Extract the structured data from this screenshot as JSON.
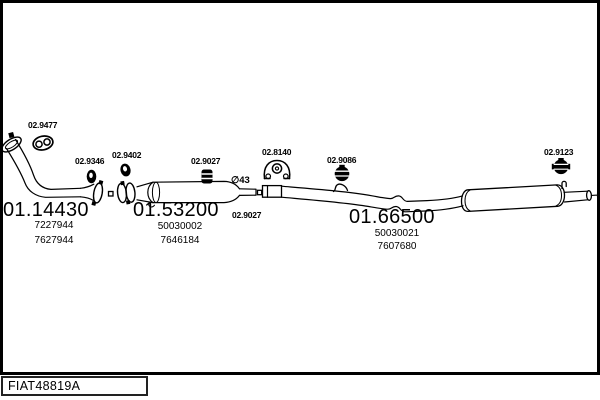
{
  "diagram": {
    "drawing_code": "FIAT48819A",
    "pipe_diameter_label": "∅43",
    "sections": [
      {
        "code": "01.14430",
        "numbers": [
          "7227944",
          "7627944"
        ]
      },
      {
        "code": "01.53200",
        "numbers": [
          "50030002",
          "7646184"
        ]
      },
      {
        "code": "01.66500",
        "numbers": [
          "50030021",
          "7607680"
        ]
      }
    ],
    "fittings": [
      {
        "code": "02.9477",
        "icon": "gasket-icon"
      },
      {
        "code": "02.9346",
        "icon": "ring-clamp-icon"
      },
      {
        "code": "02.9402",
        "icon": "ring-clamp-icon"
      },
      {
        "code": "02.9027",
        "icon": "bolt-clamp-icon"
      },
      {
        "code": "02.8140",
        "icon": "rubber-mount-icon"
      },
      {
        "code": "02.9086",
        "icon": "band-clamp-icon"
      },
      {
        "code": "02.9123",
        "icon": "band-clamp-icon"
      },
      {
        "code": "02.9027",
        "icon": "bolt-clamp-icon"
      }
    ],
    "colors": {
      "line": "#000000",
      "background": "#ffffff",
      "text": "#000000"
    }
  }
}
